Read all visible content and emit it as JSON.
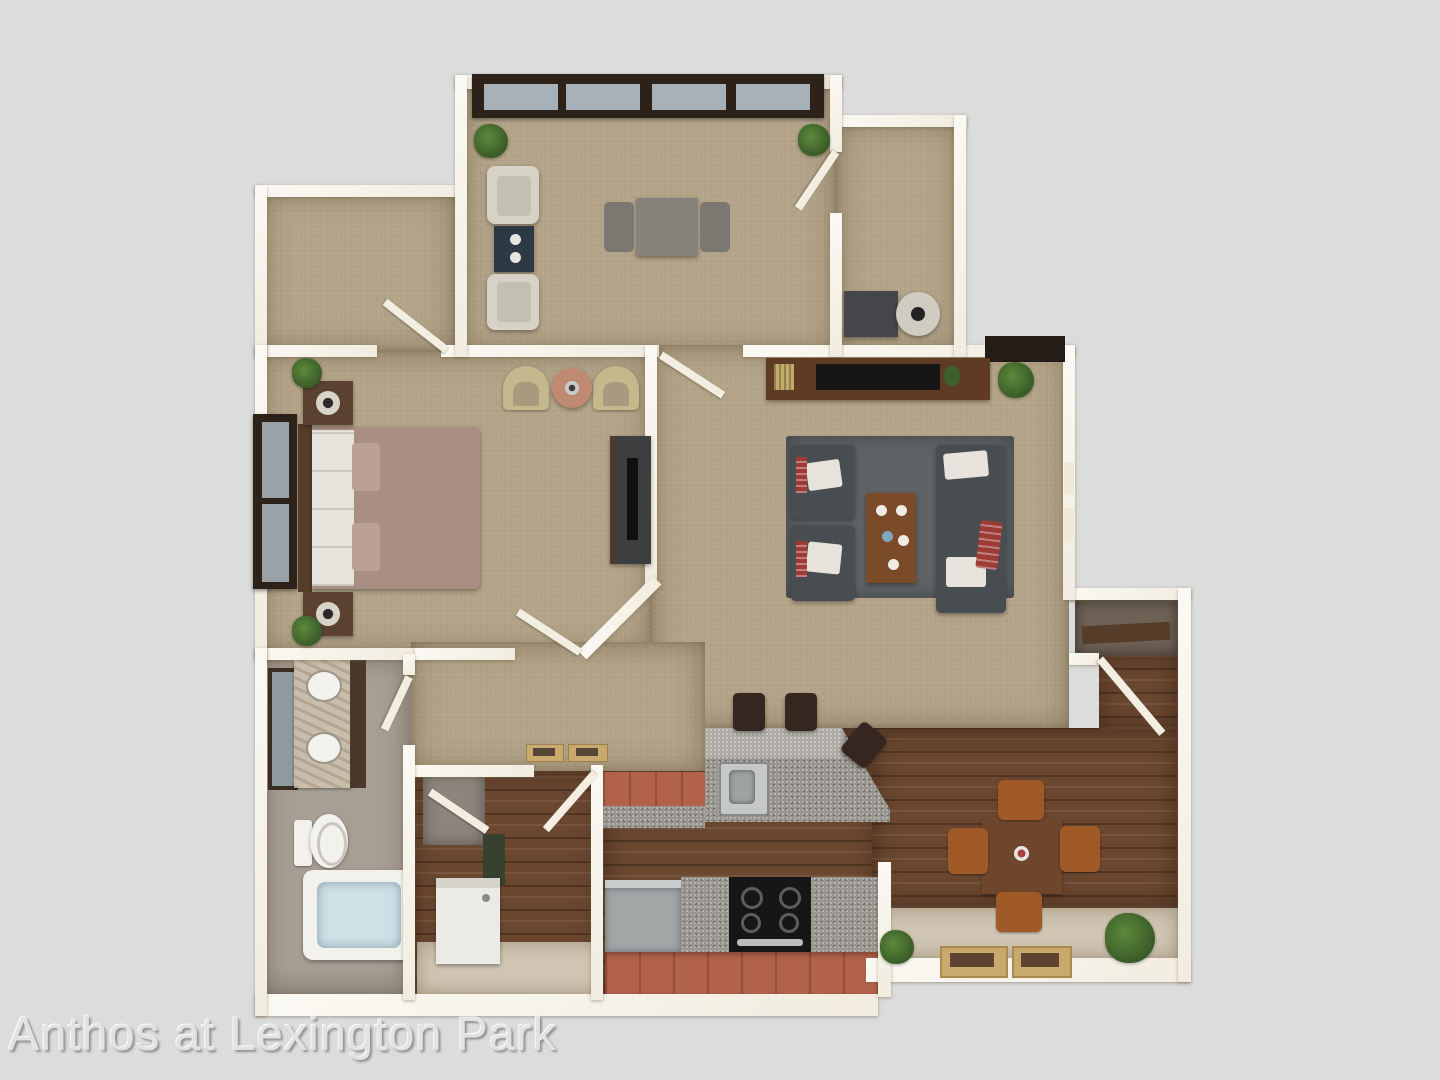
{
  "image": {
    "kind": "3d-apartment-floor-plan-rendering",
    "width": 1440,
    "height": 1080
  },
  "watermark": {
    "text": "Anthos at Lexington Park"
  },
  "palette": {
    "background": "#dbdcdc",
    "carpet": "#b3a489",
    "wood": "#6b4730",
    "beige_floor": "#cfc5b2",
    "bath_floor": "#a89f94",
    "granite": "#98958f",
    "granite_light": "#aeaba5",
    "cabinet_orange": "#b26248",
    "sofa_gray": "#484d51",
    "rug_gray": "#5f6366",
    "pillow_white": "#e7e3dc",
    "accent_red": "#9d3b35",
    "bed_mauve": "#a98f83",
    "dark_wood": "#553d2a",
    "console_brown": "#5f3b24",
    "tv_black": "#161616",
    "window_frame": "#2c2219",
    "window_pane": "#a8b1b8",
    "plant": "#41652c",
    "plant_dark": "#2c4a1e",
    "cream_chair": "#d6d2c6",
    "tub_chair": "#c4b98d",
    "navy_table": "#2d3945",
    "white_fixture": "#f2f1ec",
    "tub_water": "#cfe0e6",
    "marble": "#c8bcaa",
    "stool_dark": "#362620",
    "dining_chair": "#a05a28",
    "mat_tan": "#c8a96e",
    "watermark": "#e2e2e2",
    "watermark_shadow": "#8f8f8f"
  }
}
